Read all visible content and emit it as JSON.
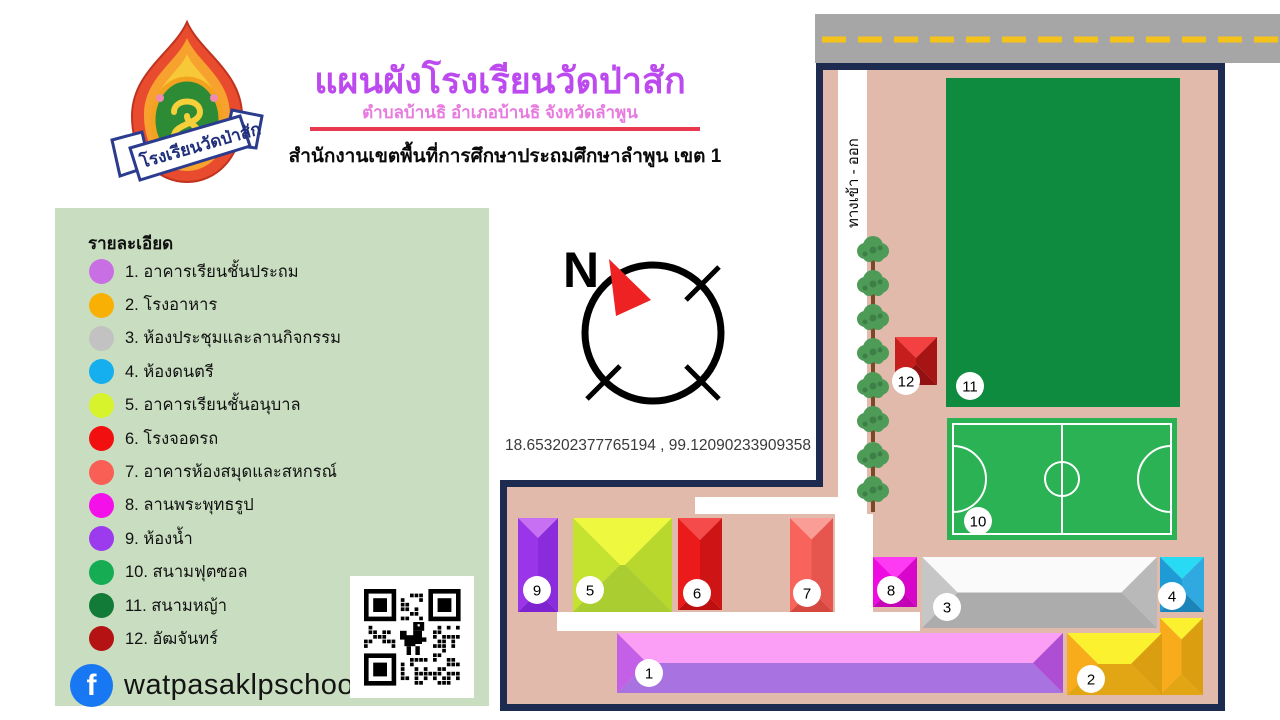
{
  "header": {
    "title": "แผนผังโรงเรียนวัดป่าสัก",
    "subtitle": "ตำบลบ้านธิ อำเภอบ้านธิ จังหวัดลำพูน",
    "organization": "สำนักงานเขตพื้นที่การศึกษาประถมศึกษาลำพูน เขต 1",
    "logo_banner": "โรงเรียนวัดป่าสัก"
  },
  "legend": {
    "title": "รายละเอียด",
    "items": [
      {
        "num": "1",
        "label": "1. อาคารเรียนชั้นประถม",
        "color": "#c76fe3"
      },
      {
        "num": "2",
        "label": "2. โรงอาหาร",
        "color": "#f9b004"
      },
      {
        "num": "3",
        "label": "3. ห้องประชุมและลานกิจกรรม",
        "color": "#c2c2c2"
      },
      {
        "num": "4",
        "label": "4. ห้องดนตรี",
        "color": "#15aeef"
      },
      {
        "num": "5",
        "label": "5. อาคารเรียนชั้นอนุบาล",
        "color": "#d6f32c"
      },
      {
        "num": "6",
        "label": "6. โรงจอดรถ",
        "color": "#f20f0f"
      },
      {
        "num": "7",
        "label": "7. อาคารห้องสมุดและสหกรณ์",
        "color": "#f95f55"
      },
      {
        "num": "8",
        "label": "8. ลานพระพุทธรูป",
        "color": "#f411e9"
      },
      {
        "num": "9",
        "label": "9. ห้องน้ำ",
        "color": "#9c3bed"
      },
      {
        "num": "10",
        "label": "10. สนามฟุตซอล",
        "color": "#15ac54"
      },
      {
        "num": "11",
        "label": "11. สนามหญ้า",
        "color": "#127b38"
      },
      {
        "num": "12",
        "label": "12. อัฒจันทร์",
        "color": "#b51313"
      }
    ]
  },
  "compass": {
    "north_label": "N"
  },
  "coordinates": "18.653202377765194 , 99.12090233909358",
  "social": {
    "facebook_handle": "watpasaklpschool"
  },
  "map": {
    "entrance_label": "ทางเข้า - ออก",
    "markers": [
      {
        "n": "1",
        "cx": 649,
        "cy": 673
      },
      {
        "n": "2",
        "cx": 1091,
        "cy": 679
      },
      {
        "n": "3",
        "cx": 947,
        "cy": 607
      },
      {
        "n": "4",
        "cx": 1172,
        "cy": 596
      },
      {
        "n": "5",
        "cx": 590,
        "cy": 590
      },
      {
        "n": "6",
        "cx": 697,
        "cy": 593
      },
      {
        "n": "7",
        "cx": 807,
        "cy": 593
      },
      {
        "n": "8",
        "cx": 891,
        "cy": 590
      },
      {
        "n": "9",
        "cx": 537,
        "cy": 590
      },
      {
        "n": "10",
        "cx": 978,
        "cy": 521
      },
      {
        "n": "11",
        "cx": 970,
        "cy": 386
      },
      {
        "n": "12",
        "cx": 906,
        "cy": 381
      }
    ],
    "buildings": [
      {
        "id": "12",
        "rect": [
          895,
          337,
          42,
          48
        ],
        "faces": {
          "top": "#f34141",
          "left": "#c61d1d",
          "right": "#a71414",
          "bottom": "#921111"
        }
      },
      {
        "id": "9",
        "rect": [
          518,
          518,
          40,
          94
        ],
        "faces": {
          "top": "#c770f4",
          "left": "#9a35ea",
          "right": "#8b2cdc",
          "bottom": "#7d23cf"
        }
      },
      {
        "id": "5",
        "rect": [
          573,
          518,
          99,
          94
        ],
        "faces": {
          "top": "#edf83e",
          "left": "#c4e230",
          "right": "#b8d82e",
          "bottom": "#aace31"
        }
      },
      {
        "id": "6",
        "rect": [
          678,
          518,
          44,
          92
        ],
        "faces": {
          "top": "#f64b4b",
          "left": "#eb1b1b",
          "right": "#ce1414",
          "bottom": "#bd0f0f"
        }
      },
      {
        "id": "7",
        "rect": [
          790,
          518,
          43,
          94
        ],
        "faces": {
          "top": "#fb9d97",
          "left": "#f8645c",
          "right": "#e6564f",
          "bottom": "#d6483f"
        }
      },
      {
        "id": "8",
        "rect": [
          873,
          557,
          44,
          50
        ],
        "faces": {
          "top": "#fe3bf2",
          "left": "#ef0ae2",
          "right": "#d805cb",
          "bottom": "#c203b6"
        }
      },
      {
        "id": "3",
        "rect": [
          922,
          557,
          235,
          71
        ],
        "faces": {
          "top": "#fafafa",
          "left": "#c6c6c6",
          "right": "#b9b9b9",
          "bottom": "#acacac"
        }
      },
      {
        "id": "4",
        "rect": [
          1160,
          557,
          44,
          55
        ],
        "faces": {
          "top": "#29daf4",
          "left": "#1e9bd4",
          "right": "#2fa9df",
          "bottom": "#1b85ba"
        }
      },
      {
        "id": "2-tower",
        "rect": [
          1160,
          618,
          43,
          77
        ],
        "faces": {
          "top": "#fbf12e",
          "left": "#f8ac1c",
          "right": "#da9e10",
          "bottom": "#e2a513"
        }
      },
      {
        "id": "2",
        "rect": [
          1067,
          633,
          95,
          62
        ],
        "faces": {
          "top": "#fbf12e",
          "left": "#f8ac1c",
          "right": "#da9e10",
          "bottom": "#e2a513"
        }
      },
      {
        "id": "1",
        "rect": [
          617,
          633,
          446,
          60
        ],
        "faces": {
          "top": "#fb9ef6",
          "left": "#c45fe8",
          "right": "#ad4ed4",
          "bottom": "#a872e1"
        }
      }
    ],
    "trees": {
      "x": 873,
      "tops": [
        238,
        272,
        306,
        340,
        374,
        408,
        444,
        478
      ]
    }
  },
  "colors": {
    "accent_title": "#bc4aef",
    "accent_subtitle": "#e77bdf",
    "divider_red": "#e8394f",
    "panel_green": "#c9dec1",
    "map_ground": "#e2baac",
    "map_border": "#1c2b4f",
    "road_gray": "#a6a6a6",
    "road_dash_yellow": "#f5c21c",
    "grass_dark": "#0e8b3e",
    "futsal_green": "#2bb254",
    "path_white": "#ffffff",
    "facebook_blue": "#1877f2",
    "compass_red": "#ee2222",
    "tree_crown": "#4e9b57",
    "tree_trunk": "#7a4928"
  }
}
